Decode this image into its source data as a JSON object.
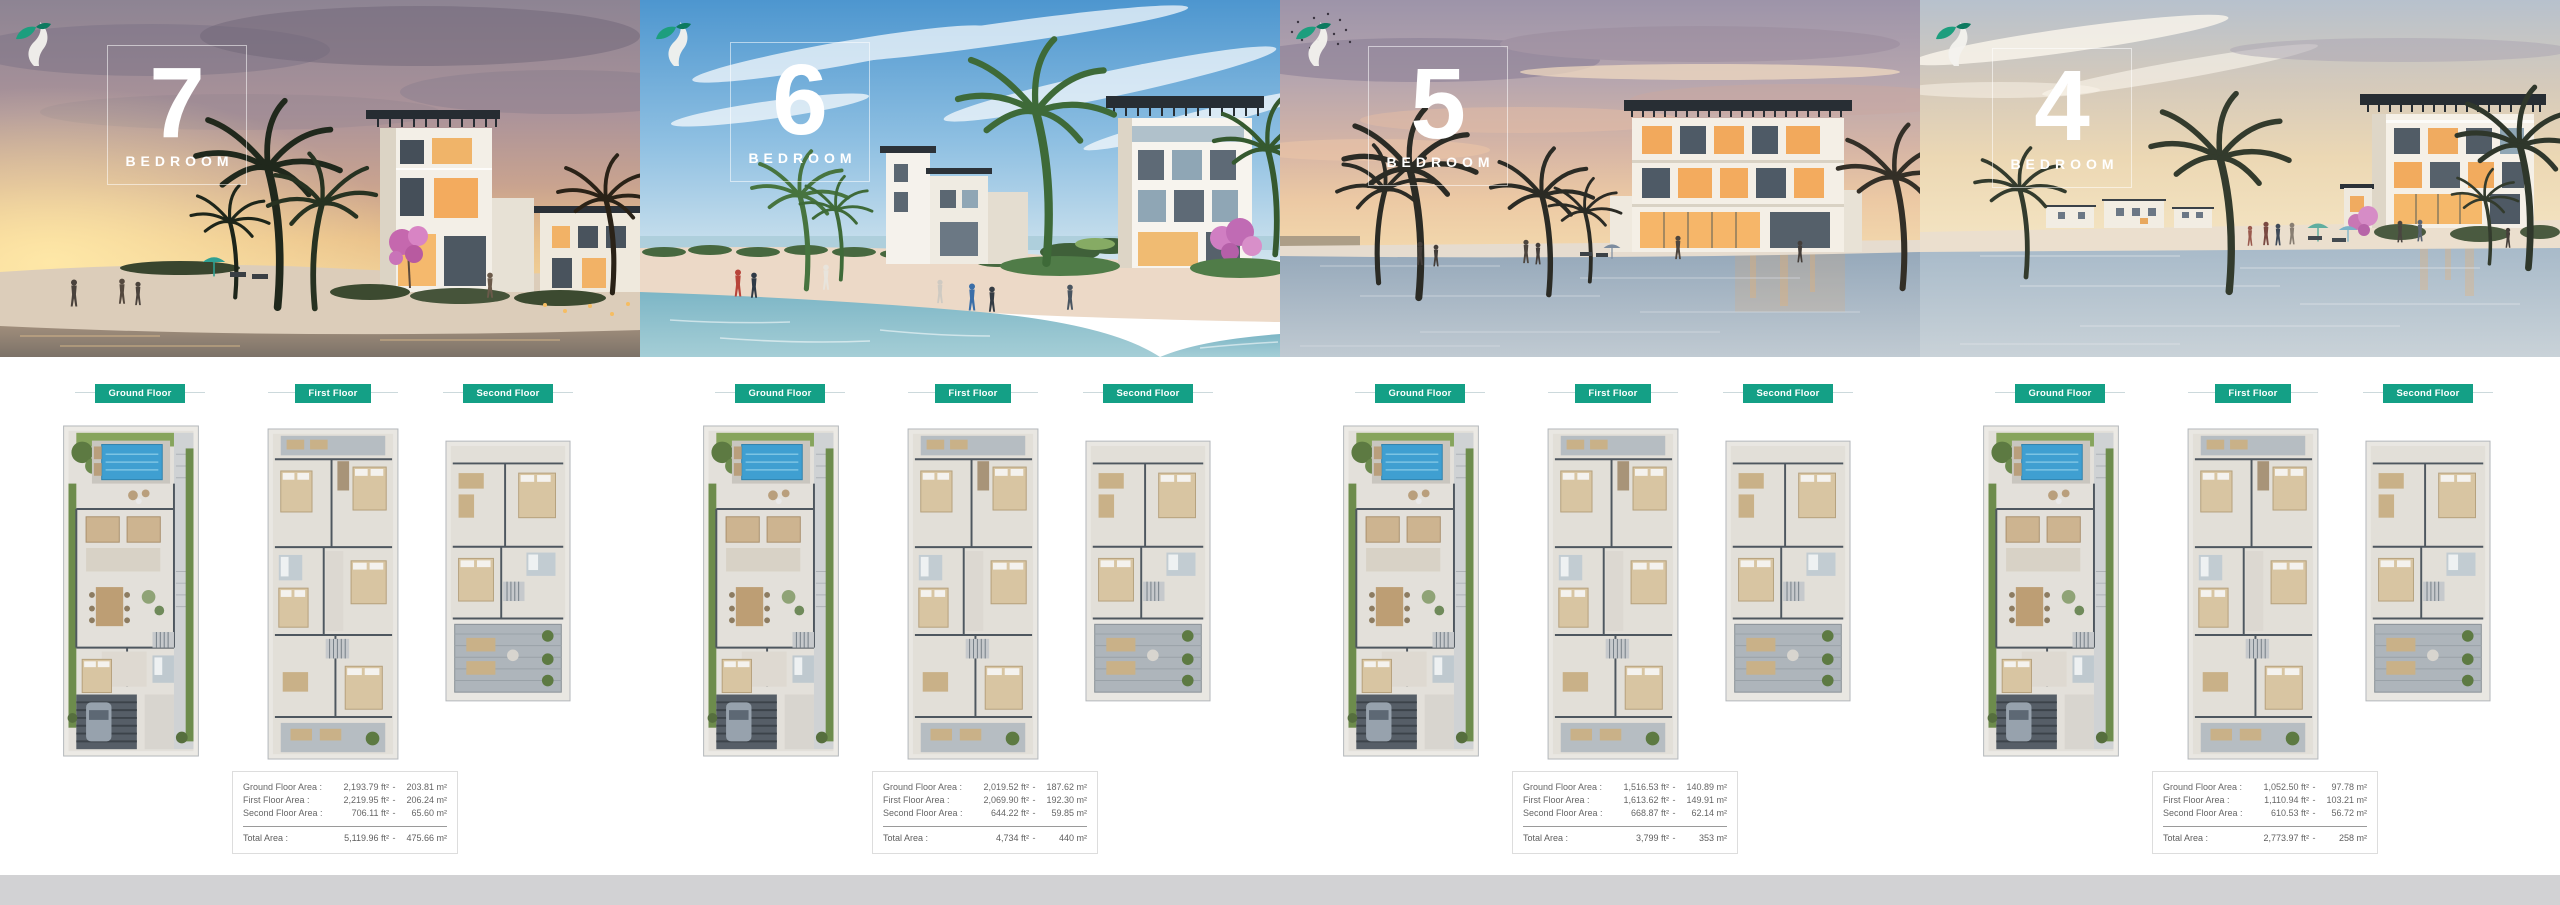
{
  "separator": "-",
  "accent_color": "#14a086",
  "footer_color": "#d2d2d4",
  "panels": [
    {
      "name": "7-bedroom-villa",
      "number": "7",
      "bedroom_word": "BEDROOM",
      "floor_labels": [
        "Ground Floor",
        "First Floor",
        "Second Floor"
      ],
      "table": {
        "rows": [
          {
            "label": "Ground Floor Area :",
            "sqft": "2,193.79 ft²",
            "sqm": "203.81 m²"
          },
          {
            "label": "First Floor Area :",
            "sqft": "2,219.95 ft²",
            "sqm": "206.24 m²"
          },
          {
            "label": "Second Floor Area :",
            "sqft": "706.11 ft²",
            "sqm": "65.60 m²"
          }
        ],
        "total": {
          "label": "Total Area :",
          "sqft": "5,119.96 ft²",
          "sqm": "475.66 m²"
        }
      }
    },
    {
      "name": "6-bedroom-villa",
      "number": "6",
      "bedroom_word": "BEDROOM",
      "floor_labels": [
        "Ground Floor",
        "First Floor",
        "Second Floor"
      ],
      "table": {
        "rows": [
          {
            "label": "Ground Floor Area :",
            "sqft": "2,019.52 ft²",
            "sqm": "187.62 m²"
          },
          {
            "label": "First Floor Area :",
            "sqft": "2,069.90 ft²",
            "sqm": "192.30 m²"
          },
          {
            "label": "Second Floor Area :",
            "sqft": "644.22 ft²",
            "sqm": "59.85 m²"
          }
        ],
        "total": {
          "label": "Total Area :",
          "sqft": "4,734 ft²",
          "sqm": "440 m²"
        }
      }
    },
    {
      "name": "5-bedroom-villa",
      "number": "5",
      "bedroom_word": "BEDROOM",
      "floor_labels": [
        "Ground Floor",
        "First Floor",
        "Second Floor"
      ],
      "table": {
        "rows": [
          {
            "label": "Ground Floor Area :",
            "sqft": "1,516.53 ft²",
            "sqm": "140.89 m²"
          },
          {
            "label": "First Floor Area :",
            "sqft": "1,613.62 ft²",
            "sqm": "149.91 m²"
          },
          {
            "label": "Second Floor Area :",
            "sqft": "668.87 ft²",
            "sqm": "62.14 m²"
          }
        ],
        "total": {
          "label": "Total Area :",
          "sqft": "3,799 ft²",
          "sqm": "353 m²"
        }
      }
    },
    {
      "name": "4-bedroom-villa",
      "number": "4",
      "bedroom_word": "BEDROOM",
      "floor_labels": [
        "Ground Floor",
        "First Floor",
        "Second Floor"
      ],
      "table": {
        "rows": [
          {
            "label": "Ground Floor Area :",
            "sqft": "1,052.50 ft²",
            "sqm": "97.78 m²"
          },
          {
            "label": "First Floor Area :",
            "sqft": "1,110.94 ft²",
            "sqm": "103.21 m²"
          },
          {
            "label": "Second Floor Area :",
            "sqft": "610.53 ft²",
            "sqm": "56.72 m²"
          }
        ],
        "total": {
          "label": "Total Area :",
          "sqft": "2,773.97 ft²",
          "sqm": "258 m²"
        }
      }
    }
  ]
}
